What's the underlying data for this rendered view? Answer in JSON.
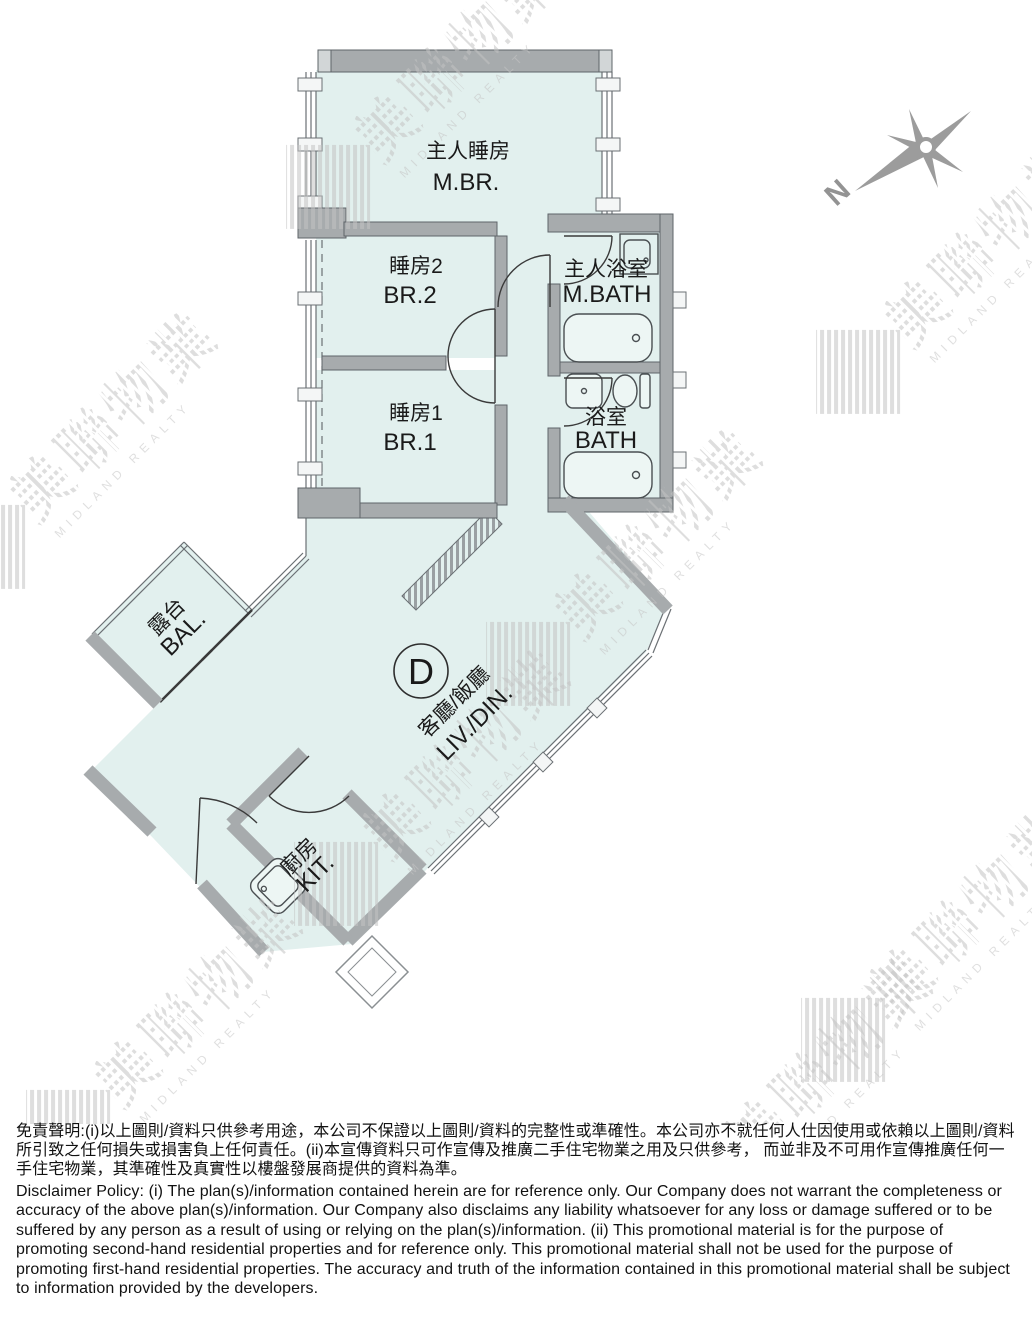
{
  "plan": {
    "unit_label": "D",
    "compass_label": "N",
    "rooms": {
      "master_bedroom": {
        "zh": "主人睡房",
        "en": "M.BR."
      },
      "bedroom2": {
        "zh": "睡房2",
        "en": "BR.2"
      },
      "bedroom1": {
        "zh": "睡房1",
        "en": "BR.1"
      },
      "master_bath": {
        "zh": "主人浴室",
        "en": "M.BATH"
      },
      "bath": {
        "zh": "浴室",
        "en": "BATH"
      },
      "balcony": {
        "zh": "露台",
        "en": "BAL."
      },
      "living_dining": {
        "zh": "客廳/飯廳",
        "en": "LIV./DIN."
      },
      "kitchen": {
        "zh": "廚房",
        "en": "KIT."
      }
    }
  },
  "watermark": {
    "zh": "美聯物業",
    "en": "MIDLAND REALTY"
  },
  "disclaimer": {
    "zh": "免責聲明:(i)以上圖則/資料只供參考用途，本公司不保證以上圖則/資料的完整性或準確性。本公司亦不就任何人仕因使用或依賴以上圖則/資料所引致之任何損失或損害負上任何責任。(ii)本宣傳資料只可作宣傳及推廣二手住宅物業之用及只供參考， 而並非及不可用作宣傳推廣任何一手住宅物業，其準確性及真實性以樓盤發展商提供的資料為準。",
    "en": "Disclaimer Policy: (i) The plan(s)/information contained herein are for reference only. Our Company does not warrant the completeness or accuracy of the above plan(s)/information. Our Company also disclaims any liability whatsoever for any loss or damage suffered or to be suffered by any person as a result of using or relying on the plan(s)/information. (ii) This promotional material is for the purpose of promoting second-hand residential properties and for reference only. This promotional material shall not be used for the purpose of promoting first-hand residential properties. The accuracy and truth of the information contained in this promotional material shall be subject to information provided by the developers."
  },
  "colors": {
    "room_fill": "#e2f0ee",
    "wall": "#a7abad",
    "watermark": "#c6c6c6",
    "label_text": "#1a1a1a"
  }
}
